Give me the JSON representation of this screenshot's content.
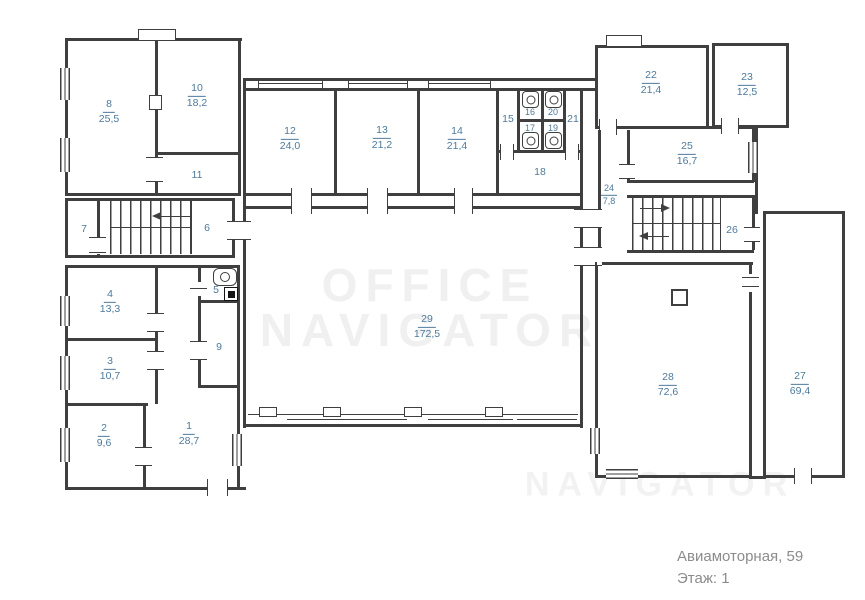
{
  "footer": {
    "address": "Авиамоторная, 59",
    "floor": "Этаж: 1"
  },
  "watermark": {
    "line1": "OFFICE",
    "line2": "NAVIGATOR"
  },
  "colors": {
    "wall": "#3f3f3f",
    "room_label": "#4d7a9c",
    "footer_text": "#8c8c8c"
  },
  "rooms": {
    "r1": {
      "number": "1",
      "area": "28,7"
    },
    "r2": {
      "number": "2",
      "area": "9,6"
    },
    "r3": {
      "number": "3",
      "area": "10,7"
    },
    "r4": {
      "number": "4",
      "area": "13,3"
    },
    "r5": {
      "number": "5"
    },
    "r6": {
      "number": "6"
    },
    "r7": {
      "number": "7"
    },
    "r8": {
      "number": "8",
      "area": "25,5"
    },
    "r9": {
      "number": "9"
    },
    "r10": {
      "number": "10",
      "area": "18,2"
    },
    "r11": {
      "number": "11"
    },
    "r12": {
      "number": "12",
      "area": "24,0"
    },
    "r13": {
      "number": "13",
      "area": "21,2"
    },
    "r14": {
      "number": "14",
      "area": "21,4"
    },
    "r15": {
      "number": "15"
    },
    "r16": {
      "number": "16"
    },
    "r17": {
      "number": "17"
    },
    "r18": {
      "number": "18"
    },
    "r19": {
      "number": "19"
    },
    "r20": {
      "number": "20"
    },
    "r21": {
      "number": "21"
    },
    "r22": {
      "number": "22",
      "area": "21,4"
    },
    "r23": {
      "number": "23",
      "area": "12,5"
    },
    "r24": {
      "number": "24",
      "area": "7,8"
    },
    "r25": {
      "number": "25",
      "area": "16,7"
    },
    "r26": {
      "number": "26"
    },
    "r27": {
      "number": "27",
      "area": "69,4"
    },
    "r28": {
      "number": "28",
      "area": "72,6"
    },
    "r29": {
      "number": "29",
      "area": "172,5"
    }
  }
}
